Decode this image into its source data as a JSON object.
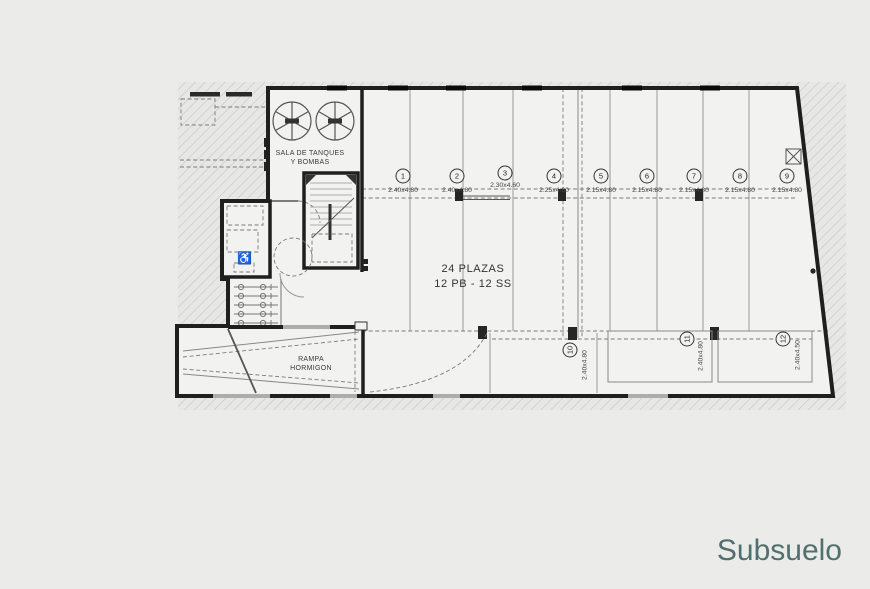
{
  "floor_label": "Subsuelo",
  "colors": {
    "background": "#ebebe9",
    "paper": "#f2f2f0",
    "wall": "#1f1f1f",
    "accent_title": "#507070"
  },
  "plan": {
    "tank_room": {
      "line1": "SALA DE TANQUES",
      "line2": "Y BOMBAS"
    },
    "capacity": {
      "line1": "24 PLAZAS",
      "line2": "12 PB - 12 SS"
    },
    "ramp": {
      "line1": "RAMPA",
      "line2": "HORMIGON"
    },
    "top_spaces": [
      {
        "num": "1",
        "dim": "2.40x4.80"
      },
      {
        "num": "2",
        "dim": "2.40x4.80"
      },
      {
        "num": "3",
        "dim": "2.30x4.60"
      },
      {
        "num": "4",
        "dim": "2.25x4.80"
      },
      {
        "num": "5",
        "dim": "2.15x4.80"
      },
      {
        "num": "6",
        "dim": "2.15x4.80"
      },
      {
        "num": "7",
        "dim": "2.15x4.80"
      },
      {
        "num": "8",
        "dim": "2.15x4.80"
      },
      {
        "num": "9",
        "dim": "2.15x4.80"
      }
    ],
    "bottom_spaces": [
      {
        "num": "10",
        "dim": "2.40x4.80"
      },
      {
        "num": "11",
        "dim": "2.40x4.80"
      },
      {
        "num": "12",
        "dim": "2.40x4.50"
      }
    ]
  }
}
